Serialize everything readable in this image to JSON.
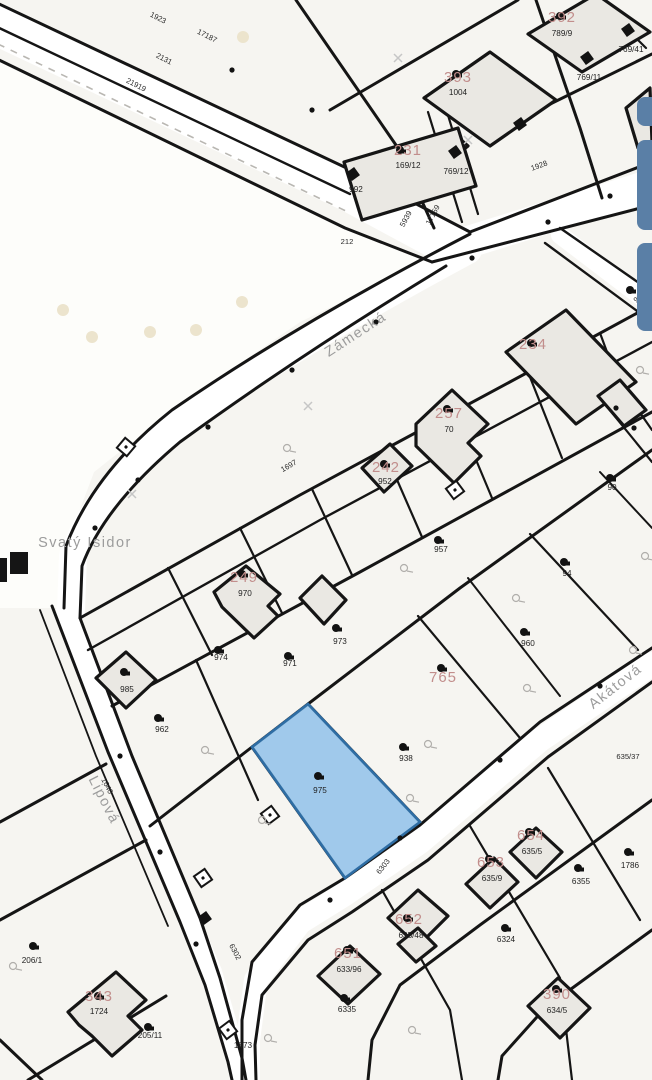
{
  "app": {
    "type": "cadastral-map-screenshot"
  },
  "colors": {
    "bg": "#f6f5f1",
    "field": "#fdfdfa",
    "line": "#151515",
    "building_fill": "#eae8e3",
    "road": "#ffffff",
    "highlight_fill": "#8cbfe9",
    "highlight_stroke": "#2e6da4",
    "label_red": "#c28e8c",
    "label_black": "#1f1f1f",
    "label_road": "#2a2a2a",
    "street": "#9c9c9c",
    "ui_button": "#5a7fa6",
    "field_dot": "#ece4cd",
    "grass": "#b0aeab"
  },
  "highlight": {
    "parcel_label": "975"
  },
  "map": {
    "streets": [
      {
        "t": "Zámecká",
        "x": 358,
        "y": 338,
        "r": -33
      },
      {
        "t": "Lipová",
        "x": 100,
        "y": 802,
        "r": 63
      },
      {
        "t": "Akátová",
        "x": 618,
        "y": 690,
        "r": -38
      },
      {
        "t": "Svatý Isidor",
        "x": 85,
        "y": 547,
        "r": 0
      }
    ],
    "labels": {
      "red": [
        {
          "t": "231",
          "x": 408,
          "y": 155
        },
        {
          "t": "393",
          "x": 458,
          "y": 82
        },
        {
          "t": "392",
          "x": 562,
          "y": 22
        },
        {
          "t": "234",
          "x": 533,
          "y": 349
        },
        {
          "t": "257",
          "x": 449,
          "y": 418
        },
        {
          "t": "242",
          "x": 386,
          "y": 472
        },
        {
          "t": "249",
          "x": 244,
          "y": 582
        },
        {
          "t": "765",
          "x": 443,
          "y": 682
        },
        {
          "t": "652",
          "x": 409,
          "y": 924
        },
        {
          "t": "653",
          "x": 491,
          "y": 867
        },
        {
          "t": "654",
          "x": 531,
          "y": 840
        },
        {
          "t": "651",
          "x": 348,
          "y": 958
        },
        {
          "t": "390",
          "x": 557,
          "y": 999
        },
        {
          "t": "343",
          "x": 99,
          "y": 1001
        }
      ],
      "parcel": [
        {
          "t": "169/12",
          "x": 408,
          "y": 168
        },
        {
          "t": "1004",
          "x": 458,
          "y": 95
        },
        {
          "t": "789/9",
          "x": 562,
          "y": 36
        },
        {
          "t": "769/41",
          "x": 631,
          "y": 52
        },
        {
          "t": "769/11",
          "x": 589,
          "y": 80
        },
        {
          "t": "769/12",
          "x": 456,
          "y": 174
        },
        {
          "t": "992",
          "x": 356,
          "y": 192
        },
        {
          "t": "70",
          "x": 449,
          "y": 432
        },
        {
          "t": "952",
          "x": 385,
          "y": 484
        },
        {
          "t": "970",
          "x": 245,
          "y": 596
        },
        {
          "t": "974",
          "x": 221,
          "y": 660
        },
        {
          "t": "971",
          "x": 290,
          "y": 666
        },
        {
          "t": "973",
          "x": 340,
          "y": 644
        },
        {
          "t": "957",
          "x": 441,
          "y": 552
        },
        {
          "t": "94",
          "x": 567,
          "y": 576
        },
        {
          "t": "960",
          "x": 528,
          "y": 646
        },
        {
          "t": "985",
          "x": 127,
          "y": 692
        },
        {
          "t": "962",
          "x": 162,
          "y": 732
        },
        {
          "t": "938",
          "x": 406,
          "y": 761
        },
        {
          "t": "975",
          "x": 320,
          "y": 793
        },
        {
          "t": "90",
          "x": 612,
          "y": 490
        },
        {
          "t": "6355",
          "x": 581,
          "y": 884
        },
        {
          "t": "6324",
          "x": 506,
          "y": 942
        },
        {
          "t": "635/48",
          "x": 411,
          "y": 938
        },
        {
          "t": "635/9",
          "x": 492,
          "y": 881
        },
        {
          "t": "635/5",
          "x": 532,
          "y": 854
        },
        {
          "t": "633/96",
          "x": 349,
          "y": 972
        },
        {
          "t": "634/5",
          "x": 557,
          "y": 1013
        },
        {
          "t": "1724",
          "x": 99,
          "y": 1014
        },
        {
          "t": "206/1",
          "x": 32,
          "y": 963
        },
        {
          "t": "205/11",
          "x": 150,
          "y": 1038
        },
        {
          "t": "1873",
          "x": 243,
          "y": 1048
        },
        {
          "t": "6335",
          "x": 347,
          "y": 1012
        },
        {
          "t": "1786",
          "x": 630,
          "y": 868
        }
      ],
      "road": [
        {
          "t": "1923",
          "x": 157,
          "y": 20,
          "r": 27
        },
        {
          "t": "17187",
          "x": 206,
          "y": 38,
          "r": 27
        },
        {
          "t": "2131",
          "x": 163,
          "y": 61,
          "r": 27
        },
        {
          "t": "21919",
          "x": 135,
          "y": 87,
          "r": 27
        },
        {
          "t": "5939",
          "x": 408,
          "y": 220,
          "r": -62
        },
        {
          "t": "17159",
          "x": 435,
          "y": 216,
          "r": -62
        },
        {
          "t": "1928",
          "x": 540,
          "y": 168,
          "r": -20
        },
        {
          "t": "212",
          "x": 347,
          "y": 244,
          "r": 0
        },
        {
          "t": "1697",
          "x": 290,
          "y": 468,
          "r": -30
        },
        {
          "t": "1640",
          "x": 105,
          "y": 787,
          "r": 63
        },
        {
          "t": "6302",
          "x": 233,
          "y": 953,
          "r": 62
        },
        {
          "t": "6303",
          "x": 385,
          "y": 868,
          "r": -52
        },
        {
          "t": "989",
          "x": 641,
          "y": 299,
          "r": -40
        },
        {
          "t": "635/37",
          "x": 628,
          "y": 759,
          "r": 0
        }
      ]
    },
    "symbols": [
      {
        "k": "blob",
        "x": 400,
        "y": 150
      },
      {
        "k": "blob",
        "x": 456,
        "y": 74
      },
      {
        "k": "blob",
        "x": 560,
        "y": 16
      },
      {
        "k": "blob",
        "x": 531,
        "y": 343
      },
      {
        "k": "blob",
        "x": 447,
        "y": 409
      },
      {
        "k": "blob",
        "x": 384,
        "y": 464
      },
      {
        "k": "blob",
        "x": 242,
        "y": 574
      },
      {
        "k": "blob",
        "x": 218,
        "y": 650
      },
      {
        "k": "blob",
        "x": 288,
        "y": 656
      },
      {
        "k": "blob",
        "x": 336,
        "y": 628
      },
      {
        "k": "blob",
        "x": 438,
        "y": 540
      },
      {
        "k": "blob",
        "x": 564,
        "y": 562
      },
      {
        "k": "blob",
        "x": 524,
        "y": 632
      },
      {
        "k": "blob",
        "x": 403,
        "y": 747
      },
      {
        "k": "blob",
        "x": 318,
        "y": 776
      },
      {
        "k": "blob",
        "x": 158,
        "y": 718
      },
      {
        "k": "blob",
        "x": 124,
        "y": 672
      },
      {
        "k": "blob",
        "x": 578,
        "y": 868
      },
      {
        "k": "blob",
        "x": 505,
        "y": 928
      },
      {
        "k": "blob",
        "x": 407,
        "y": 918
      },
      {
        "k": "blob",
        "x": 489,
        "y": 859
      },
      {
        "k": "blob",
        "x": 529,
        "y": 832
      },
      {
        "k": "blob",
        "x": 556,
        "y": 989
      },
      {
        "k": "blob",
        "x": 98,
        "y": 996
      },
      {
        "k": "blob",
        "x": 148,
        "y": 1027
      },
      {
        "k": "blob",
        "x": 344,
        "y": 998
      },
      {
        "k": "blob",
        "x": 33,
        "y": 946
      },
      {
        "k": "blob",
        "x": 628,
        "y": 852
      },
      {
        "k": "blob",
        "x": 630,
        "y": 290
      },
      {
        "k": "blob",
        "x": 441,
        "y": 668
      },
      {
        "k": "blob",
        "x": 347,
        "y": 950
      },
      {
        "k": "blob",
        "x": 610,
        "y": 478
      },
      {
        "k": "square",
        "x": 455,
        "y": 152
      },
      {
        "k": "square",
        "x": 520,
        "y": 124
      },
      {
        "k": "square",
        "x": 587,
        "y": 58
      },
      {
        "k": "square",
        "x": 628,
        "y": 30
      },
      {
        "k": "square",
        "x": 353,
        "y": 174
      },
      {
        "k": "square",
        "x": 205,
        "y": 918
      },
      {
        "k": "hut",
        "x": 126,
        "y": 447,
        "r": 40
      },
      {
        "k": "hut",
        "x": 455,
        "y": 490,
        "r": -37
      },
      {
        "k": "hut",
        "x": 270,
        "y": 815,
        "r": -37
      },
      {
        "k": "hut",
        "x": 203,
        "y": 878,
        "r": 55
      },
      {
        "k": "hut",
        "x": 228,
        "y": 1030,
        "r": -37
      },
      {
        "k": "grass",
        "x": 205,
        "y": 750
      },
      {
        "k": "grass",
        "x": 262,
        "y": 820
      },
      {
        "k": "grass",
        "x": 410,
        "y": 798
      },
      {
        "k": "grass",
        "x": 428,
        "y": 744
      },
      {
        "k": "grass",
        "x": 527,
        "y": 688
      },
      {
        "k": "grass",
        "x": 633,
        "y": 650
      },
      {
        "k": "grass",
        "x": 640,
        "y": 370
      },
      {
        "k": "grass",
        "x": 516,
        "y": 598
      },
      {
        "k": "grass",
        "x": 404,
        "y": 568
      },
      {
        "k": "grass",
        "x": 645,
        "y": 556
      },
      {
        "k": "grass",
        "x": 13,
        "y": 966
      },
      {
        "k": "grass",
        "x": 268,
        "y": 1038
      },
      {
        "k": "grass",
        "x": 412,
        "y": 1030
      },
      {
        "k": "grass",
        "x": 287,
        "y": 448
      },
      {
        "k": "x",
        "x": 398,
        "y": 58
      },
      {
        "k": "x",
        "x": 468,
        "y": 140
      },
      {
        "k": "x",
        "x": 308,
        "y": 406
      },
      {
        "k": "x",
        "x": 132,
        "y": 494
      },
      {
        "k": "fdot",
        "x": 63,
        "y": 310
      },
      {
        "k": "fdot",
        "x": 92,
        "y": 337
      },
      {
        "k": "fdot",
        "x": 150,
        "y": 332
      },
      {
        "k": "fdot",
        "x": 196,
        "y": 330
      },
      {
        "k": "fdot",
        "x": 242,
        "y": 302
      },
      {
        "k": "fdot",
        "x": 243,
        "y": 37
      },
      {
        "k": "pt",
        "x": 376,
        "y": 322
      },
      {
        "k": "pt",
        "x": 292,
        "y": 370
      },
      {
        "k": "pt",
        "x": 208,
        "y": 427
      },
      {
        "k": "pt",
        "x": 138,
        "y": 480
      },
      {
        "k": "pt",
        "x": 95,
        "y": 528
      },
      {
        "k": "pt",
        "x": 472,
        "y": 258
      },
      {
        "k": "pt",
        "x": 548,
        "y": 222
      },
      {
        "k": "pt",
        "x": 610,
        "y": 196
      },
      {
        "k": "pt",
        "x": 232,
        "y": 70
      },
      {
        "k": "pt",
        "x": 312,
        "y": 110
      },
      {
        "k": "pt",
        "x": 120,
        "y": 756
      },
      {
        "k": "pt",
        "x": 160,
        "y": 852
      },
      {
        "k": "pt",
        "x": 196,
        "y": 944
      },
      {
        "k": "pt",
        "x": 600,
        "y": 686
      },
      {
        "k": "pt",
        "x": 500,
        "y": 760
      },
      {
        "k": "pt",
        "x": 400,
        "y": 838
      },
      {
        "k": "pt",
        "x": 330,
        "y": 900
      },
      {
        "k": "pt",
        "x": 616,
        "y": 408
      },
      {
        "k": "pt",
        "x": 634,
        "y": 428
      }
    ]
  },
  "ui": {
    "side_buttons": [
      {
        "x": 637,
        "y": 97,
        "w": 26,
        "h": 29
      },
      {
        "x": 637,
        "y": 140,
        "w": 26,
        "h": 90
      },
      {
        "x": 637,
        "y": 243,
        "w": 26,
        "h": 88
      }
    ]
  }
}
